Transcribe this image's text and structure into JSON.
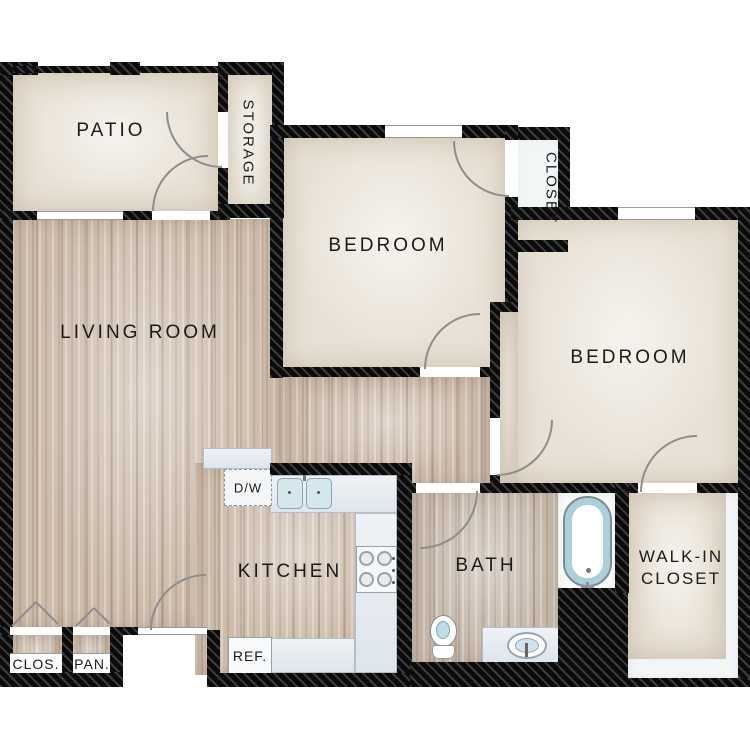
{
  "rooms": {
    "patio": {
      "label": "PATIO"
    },
    "storage": {
      "label": "STORAGE"
    },
    "bedroom1": {
      "label": "BEDROOM"
    },
    "closet": {
      "label": "CLOSET"
    },
    "bedroom2": {
      "label": "BEDROOM"
    },
    "living": {
      "label": "LIVING ROOM"
    },
    "kitchen": {
      "label": "KITCHEN"
    },
    "bath": {
      "label": "BATH"
    },
    "walk_in": {
      "line1": "WALK-IN",
      "line2": "CLOSET"
    },
    "clos": {
      "label": "CLOS."
    },
    "pan": {
      "label": "PAN."
    }
  },
  "fixtures": {
    "dishwasher": {
      "label": "D/W"
    },
    "refrigerator": {
      "label": "REF."
    }
  },
  "colors": {
    "wall": "#111111",
    "wood-floor": "#cdbcac",
    "beige-floor": "#e8e1d5",
    "closet-floor": "#f3f6f7",
    "counter": "#dee5ec",
    "fixture-blue": "#abd0d9",
    "door-arc": "#8d8d8d"
  }
}
